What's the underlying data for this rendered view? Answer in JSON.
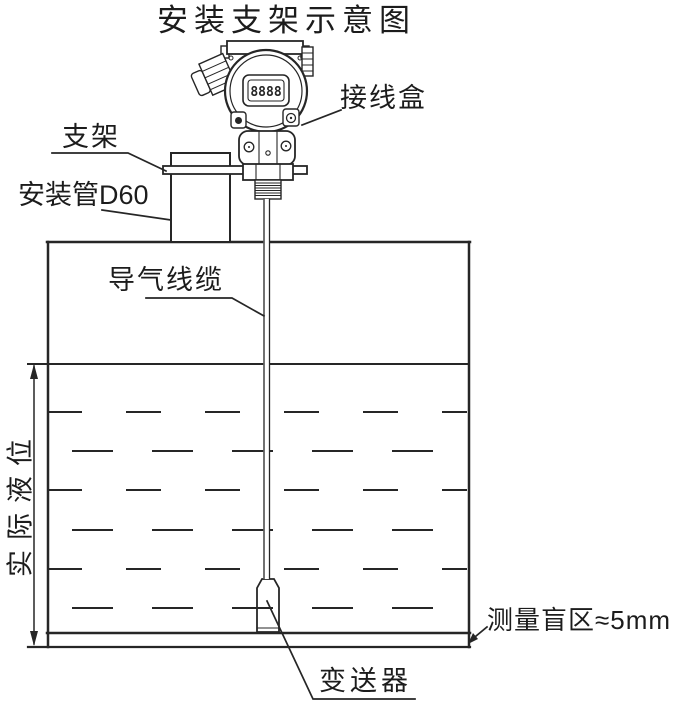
{
  "title": "安装支架示意图",
  "device": {
    "display_digits": "8888"
  },
  "annotations": {
    "junction_box": {
      "label": "接线盒"
    },
    "bracket": {
      "label": "支架"
    },
    "mounting_pipe": {
      "label": "安装管D60"
    },
    "air_cable": {
      "label": "导气线缆"
    },
    "actual_level": {
      "label": "实际液位"
    },
    "blind_zone": {
      "label": "测量盲区≈5mm"
    },
    "transmitter": {
      "label": "变送器"
    }
  },
  "colors": {
    "line": "#262626",
    "background": "#ffffff"
  }
}
